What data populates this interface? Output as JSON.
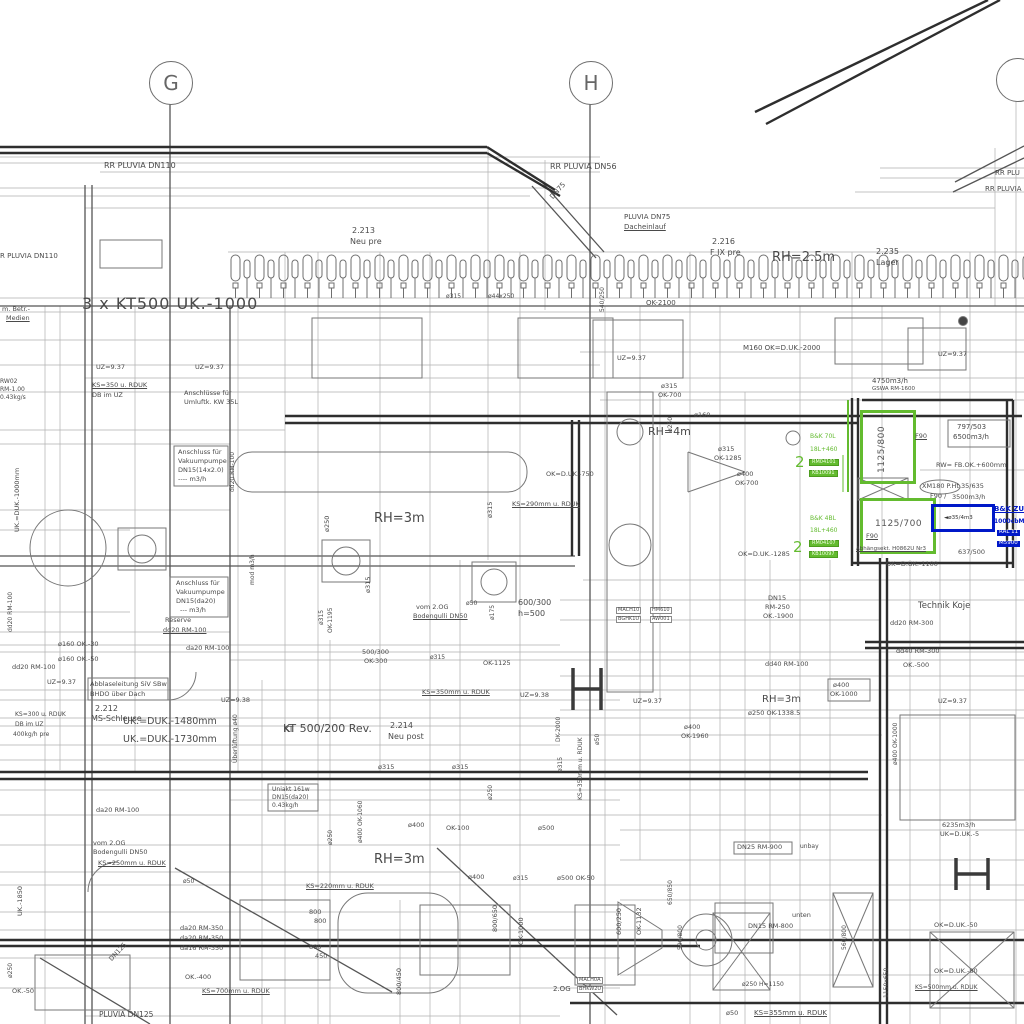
{
  "title": "HVAC / Sanitär Installationsplan (Ausschnitt)",
  "colors": {
    "line": "#6f6f6f",
    "dark": "#2e2e2e",
    "text": "#4a4a4a",
    "green": "#63bb2f",
    "blue": "#0018c8",
    "background": "#ffffff"
  },
  "grid_axes": [
    {
      "label": "G",
      "x": 149,
      "y": 61
    },
    {
      "label": "H",
      "x": 569,
      "y": 61
    },
    {
      "label": "",
      "x": 996,
      "y": 58
    }
  ],
  "equipment": {
    "supply_unit_green_1": {
      "size": "1125/800",
      "rating": "F90"
    },
    "supply_unit_green_2": {
      "size": "1125/700",
      "rating": "F90"
    },
    "blue_unit": {
      "label": "◄ø35/4m3"
    }
  },
  "annotations": [
    {
      "t": "RR PLUVIA DN110",
      "x": 104,
      "y": 162,
      "fs": 8
    },
    {
      "t": "R PLUVIA DN110",
      "x": 0,
      "y": 253,
      "fs": 7
    },
    {
      "t": "RR PLUVIA DN56",
      "x": 550,
      "y": 163,
      "fs": 8
    },
    {
      "t": "RR PLU",
      "x": 995,
      "y": 170,
      "fs": 7
    },
    {
      "t": "RR PLUVIA",
      "x": 985,
      "y": 186,
      "fs": 7
    },
    {
      "t": "DN75",
      "x": 549,
      "y": 196,
      "fs": 7,
      "r": -48
    },
    {
      "t": "PLUVIA DN75",
      "x": 624,
      "y": 214,
      "fs": 7
    },
    {
      "t": "Dacheinlauf",
      "x": 624,
      "y": 224,
      "fs": 7,
      "u": 1
    },
    {
      "t": "2.213",
      "x": 352,
      "y": 227,
      "fs": 8
    },
    {
      "t": "Neu pre",
      "x": 350,
      "y": 238,
      "fs": 8
    },
    {
      "t": "2.216",
      "x": 712,
      "y": 238,
      "fs": 8
    },
    {
      "t": "F IX pre",
      "x": 710,
      "y": 249,
      "fs": 8
    },
    {
      "t": "RH=2.5m",
      "x": 772,
      "y": 251,
      "fs": 13
    },
    {
      "t": "2.235",
      "x": 876,
      "y": 248,
      "fs": 8
    },
    {
      "t": "Lager",
      "x": 876,
      "y": 259,
      "fs": 8
    },
    {
      "t": "3 x KT500 UK.-1000",
      "x": 82,
      "y": 296,
      "fs": 16,
      "ls": 1
    },
    {
      "t": "OK-2100",
      "x": 646,
      "y": 300,
      "fs": 7
    },
    {
      "t": "m. Betr.-",
      "x": 2,
      "y": 306,
      "fs": 6.5
    },
    {
      "t": "Medien",
      "x": 6,
      "y": 315,
      "fs": 6.5,
      "u": 1
    },
    {
      "t": "UZ=9.37",
      "x": 96,
      "y": 364,
      "fs": 6.5
    },
    {
      "t": "UZ=9.37",
      "x": 195,
      "y": 364,
      "fs": 6.5
    },
    {
      "t": "UZ=9.37",
      "x": 617,
      "y": 355,
      "fs": 6.5
    },
    {
      "t": "UZ=9.37",
      "x": 938,
      "y": 351,
      "fs": 6.5
    },
    {
      "t": "KS=350 u. RDUK",
      "x": 92,
      "y": 382,
      "fs": 6.5,
      "u": 1
    },
    {
      "t": "DB im UZ",
      "x": 92,
      "y": 392,
      "fs": 6.5
    },
    {
      "t": "RW02",
      "x": 0,
      "y": 379,
      "fs": 6
    },
    {
      "t": "RM-1.00",
      "x": 0,
      "y": 387,
      "fs": 6
    },
    {
      "t": "0.43kg/s",
      "x": 0,
      "y": 395,
      "fs": 6
    },
    {
      "t": "Anschlüsse für",
      "x": 184,
      "y": 390,
      "fs": 6.5
    },
    {
      "t": "Umluftk. KW 35L",
      "x": 184,
      "y": 399,
      "fs": 6.5
    },
    {
      "t": "M160  OK=D.UK.-2000",
      "x": 743,
      "y": 345,
      "fs": 7
    },
    {
      "t": "4750m3/h",
      "x": 872,
      "y": 378,
      "fs": 7
    },
    {
      "t": "GSWA RM-1600",
      "x": 872,
      "y": 387,
      "fs": 5.5
    },
    {
      "t": "ø315",
      "x": 661,
      "y": 383,
      "fs": 6.5
    },
    {
      "t": "OK-700",
      "x": 658,
      "y": 392,
      "fs": 6.5
    },
    {
      "t": "RH=4m",
      "x": 648,
      "y": 426,
      "fs": 11
    },
    {
      "t": "ø250",
      "x": 668,
      "y": 432,
      "fs": 6,
      "r": -90
    },
    {
      "t": "ø160",
      "x": 694,
      "y": 412,
      "fs": 6.5
    },
    {
      "t": "ø315",
      "x": 718,
      "y": 446,
      "fs": 6.5
    },
    {
      "t": "OK-1285",
      "x": 714,
      "y": 455,
      "fs": 6.5
    },
    {
      "t": "ø400",
      "x": 737,
      "y": 471,
      "fs": 6.5
    },
    {
      "t": "OK-700",
      "x": 735,
      "y": 480,
      "fs": 6.5
    },
    {
      "t": "797/503",
      "x": 957,
      "y": 424,
      "fs": 7
    },
    {
      "t": "6500m3/h",
      "x": 953,
      "y": 434,
      "fs": 7
    },
    {
      "t": "RW= FB.OK.+600mm",
      "x": 936,
      "y": 462,
      "fs": 6.5
    },
    {
      "t": "XM180 P.Ht.35/635",
      "x": 922,
      "y": 483,
      "fs": 6.5
    },
    {
      "t": "F90 /",
      "x": 930,
      "y": 493,
      "fs": 6.5
    },
    {
      "t": "3500m3/h",
      "x": 952,
      "y": 494,
      "fs": 6.5
    },
    {
      "t": "B&K 70L",
      "x": 810,
      "y": 434,
      "fs": 6,
      "c": "g"
    },
    {
      "t": "18L+460",
      "x": 810,
      "y": 447,
      "fs": 6,
      "c": "g"
    },
    {
      "t": "RM04101",
      "x": 809,
      "y": 459,
      "fs": 5,
      "cls": "gbox"
    },
    {
      "t": "KB10091",
      "x": 809,
      "y": 470,
      "fs": 5,
      "cls": "gbox"
    },
    {
      "t": "2",
      "x": 795,
      "y": 455,
      "fs": 15,
      "c": "g"
    },
    {
      "t": "B&K 4BL",
      "x": 810,
      "y": 516,
      "fs": 6,
      "c": "g"
    },
    {
      "t": "18L+460",
      "x": 810,
      "y": 528,
      "fs": 6,
      "c": "g"
    },
    {
      "t": "RM04107",
      "x": 809,
      "y": 540,
      "fs": 5,
      "cls": "gbox"
    },
    {
      "t": "KB10097",
      "x": 809,
      "y": 551,
      "fs": 5,
      "cls": "gbox"
    },
    {
      "t": "2",
      "x": 793,
      "y": 540,
      "fs": 15,
      "c": "g"
    },
    {
      "t": "F90",
      "x": 915,
      "y": 433,
      "fs": 6.5,
      "u": 1
    },
    {
      "t": "F90",
      "x": 866,
      "y": 533,
      "fs": 6.5,
      "u": 1
    },
    {
      "t": "B&K ZU",
      "x": 994,
      "y": 506,
      "fs": 7,
      "c": "b",
      "u": 1
    },
    {
      "t": "1000cbM",
      "x": 994,
      "y": 519,
      "fs": 6,
      "c": "b"
    },
    {
      "t": "RAL 11",
      "x": 997,
      "y": 530,
      "fs": 5.5,
      "cls": "bbox"
    },
    {
      "t": "M5900",
      "x": 997,
      "y": 541,
      "fs": 5.5,
      "cls": "bbox"
    },
    {
      "t": "Abhängsekt. H0862U Nr3",
      "x": 856,
      "y": 547,
      "fs": 5.5,
      "u": 1
    },
    {
      "t": "637/500",
      "x": 958,
      "y": 549,
      "fs": 6.5
    },
    {
      "t": "OK=D.UK.-1100",
      "x": 886,
      "y": 561,
      "fs": 6.5
    },
    {
      "t": "OK=D.UK.-1285",
      "x": 738,
      "y": 551,
      "fs": 6.5
    },
    {
      "t": "Technik Koje",
      "x": 918,
      "y": 602,
      "fs": 8.5
    },
    {
      "t": "dd20 RM-300",
      "x": 890,
      "y": 620,
      "fs": 6.5
    },
    {
      "t": "dd40 RM-300",
      "x": 896,
      "y": 648,
      "fs": 6.5
    },
    {
      "t": "OK.-500",
      "x": 903,
      "y": 662,
      "fs": 6.5
    },
    {
      "t": "UZ=9.37",
      "x": 938,
      "y": 698,
      "fs": 6.5
    },
    {
      "t": "ø400 OK-1000",
      "x": 893,
      "y": 765,
      "fs": 6,
      "r": -90
    },
    {
      "t": "DN25  RM-900",
      "x": 737,
      "y": 844,
      "fs": 6.5
    },
    {
      "t": "unbay",
      "x": 800,
      "y": 844,
      "fs": 6
    },
    {
      "t": "6235m3/h",
      "x": 942,
      "y": 822,
      "fs": 6.5
    },
    {
      "t": "UK=D.UK.-5",
      "x": 940,
      "y": 831,
      "fs": 6.5
    },
    {
      "t": "RH=3m",
      "x": 374,
      "y": 512,
      "fs": 13
    },
    {
      "t": "OK=D.UK.-750",
      "x": 546,
      "y": 471,
      "fs": 6.5
    },
    {
      "t": "KS=290mm u. RDUK",
      "x": 512,
      "y": 501,
      "fs": 6.5,
      "u": 1
    },
    {
      "t": "ø250",
      "x": 324,
      "y": 532,
      "fs": 6.5,
      "r": -90
    },
    {
      "t": "ø315",
      "x": 487,
      "y": 518,
      "fs": 6.5,
      "r": -90
    },
    {
      "t": "ø315",
      "x": 365,
      "y": 593,
      "fs": 6.5,
      "r": -90
    },
    {
      "t": "ø315",
      "x": 319,
      "y": 625,
      "fs": 6,
      "r": -90
    },
    {
      "t": "OK-1195",
      "x": 328,
      "y": 633,
      "fs": 6,
      "r": -90
    },
    {
      "t": "ø175",
      "x": 490,
      "y": 620,
      "fs": 6,
      "r": -90
    },
    {
      "t": "vom 2.OG",
      "x": 416,
      "y": 604,
      "fs": 6.5
    },
    {
      "t": "Bodengulli DN50",
      "x": 413,
      "y": 613,
      "fs": 6.5,
      "u": 1
    },
    {
      "t": "ø50",
      "x": 466,
      "y": 601,
      "fs": 6
    },
    {
      "t": "600/300",
      "x": 518,
      "y": 599,
      "fs": 8
    },
    {
      "t": "h=500",
      "x": 518,
      "y": 610,
      "fs": 8
    },
    {
      "t": "DN15",
      "x": 768,
      "y": 595,
      "fs": 6.5
    },
    {
      "t": "RM-250",
      "x": 765,
      "y": 604,
      "fs": 6.5
    },
    {
      "t": "OK.-1900",
      "x": 763,
      "y": 613,
      "fs": 6.5
    },
    {
      "t": "dd40 RM-100",
      "x": 765,
      "y": 661,
      "fs": 6.5
    },
    {
      "t": "ø400",
      "x": 833,
      "y": 682,
      "fs": 6.5
    },
    {
      "t": "OK-1000",
      "x": 830,
      "y": 691,
      "fs": 6.5
    },
    {
      "t": "RH=3m",
      "x": 762,
      "y": 695,
      "fs": 10
    },
    {
      "t": "ø250 OK-1338.5",
      "x": 748,
      "y": 710,
      "fs": 6.5
    },
    {
      "t": "ø400",
      "x": 684,
      "y": 724,
      "fs": 6.5
    },
    {
      "t": "OK-1960",
      "x": 681,
      "y": 733,
      "fs": 6.5
    },
    {
      "t": "UZ=9.37",
      "x": 633,
      "y": 698,
      "fs": 6.5
    },
    {
      "t": "500/300",
      "x": 362,
      "y": 649,
      "fs": 6.5
    },
    {
      "t": "OK-300",
      "x": 364,
      "y": 658,
      "fs": 6.5
    },
    {
      "t": "ø315",
      "x": 430,
      "y": 655,
      "fs": 6
    },
    {
      "t": "OK-1125",
      "x": 483,
      "y": 660,
      "fs": 6.5
    },
    {
      "t": "ø160  OK.-30",
      "x": 58,
      "y": 641,
      "fs": 6.5
    },
    {
      "t": "ø160  OK.-50",
      "x": 58,
      "y": 656,
      "fs": 6.5
    },
    {
      "t": "dd20 RM-100",
      "x": 12,
      "y": 664,
      "fs": 6.5
    },
    {
      "t": "da20 RM-100",
      "x": 186,
      "y": 645,
      "fs": 6.5
    },
    {
      "t": "UZ=9.37",
      "x": 47,
      "y": 679,
      "fs": 6.5
    },
    {
      "t": "Abblaseleitung SiV SBw",
      "x": 90,
      "y": 681,
      "fs": 6.5
    },
    {
      "t": "BHDO über Dach",
      "x": 90,
      "y": 691,
      "fs": 6.5
    },
    {
      "t": "2.212",
      "x": 95,
      "y": 705,
      "fs": 8
    },
    {
      "t": "MS-Schleuse",
      "x": 91,
      "y": 715,
      "fs": 8
    },
    {
      "t": "UK.=DUK.-1480mm",
      "x": 123,
      "y": 717,
      "fs": 9.5
    },
    {
      "t": "UK.=DUK.-1730mm",
      "x": 123,
      "y": 735,
      "fs": 9.5
    },
    {
      "t": "UZ=9.38",
      "x": 221,
      "y": 697,
      "fs": 6.5
    },
    {
      "t": "Überlüftung ø40",
      "x": 233,
      "y": 763,
      "fs": 6,
      "r": -90
    },
    {
      "t": "KS=300 u. RDUK",
      "x": 15,
      "y": 712,
      "fs": 6
    },
    {
      "t": "DB im UZ",
      "x": 15,
      "y": 722,
      "fs": 6
    },
    {
      "t": "400kg/h pre",
      "x": 13,
      "y": 732,
      "fs": 6
    },
    {
      "t": "KT",
      "x": 284,
      "y": 726,
      "fs": 8
    },
    {
      "t": "Reserve",
      "x": 165,
      "y": 617,
      "fs": 6.5
    },
    {
      "t": "dd20 RM-100",
      "x": 163,
      "y": 627,
      "fs": 6.5,
      "u": 1
    },
    {
      "t": "Anschluss für",
      "x": 178,
      "y": 449,
      "fs": 6.5
    },
    {
      "t": "Vakuumpumpe",
      "x": 178,
      "y": 458,
      "fs": 6.5
    },
    {
      "t": "DN15(14x2.0)",
      "x": 178,
      "y": 467,
      "fs": 6.5
    },
    {
      "t": "---- m3/h",
      "x": 178,
      "y": 476,
      "fs": 6.5
    },
    {
      "t": "Anschluss für",
      "x": 176,
      "y": 580,
      "fs": 6.5
    },
    {
      "t": "Vakuumpumpe",
      "x": 176,
      "y": 589,
      "fs": 6.5
    },
    {
      "t": "DN15(da20)",
      "x": 176,
      "y": 598,
      "fs": 6.5
    },
    {
      "t": "--- m3/h",
      "x": 180,
      "y": 607,
      "fs": 6.5
    },
    {
      "t": "UK.=DUK.-1000mm",
      "x": 14,
      "y": 532,
      "fs": 6.5,
      "r": -90
    },
    {
      "t": "dd20 RM-100",
      "x": 8,
      "y": 632,
      "fs": 6,
      "r": -90
    },
    {
      "t": "dd20 RM-100",
      "x": 230,
      "y": 492,
      "fs": 6,
      "r": -90
    },
    {
      "t": "mod m3/h",
      "x": 250,
      "y": 585,
      "fs": 6,
      "r": -90
    },
    {
      "t": "da20 RM-100",
      "x": 96,
      "y": 807,
      "fs": 6.5
    },
    {
      "t": "vom 2.OG",
      "x": 93,
      "y": 840,
      "fs": 6.5
    },
    {
      "t": "Bodengulli DN50",
      "x": 93,
      "y": 849,
      "fs": 6.5
    },
    {
      "t": "KS=250mm u. RDUK",
      "x": 98,
      "y": 860,
      "fs": 6.5,
      "u": 1
    },
    {
      "t": "UK.-1850",
      "x": 17,
      "y": 916,
      "fs": 6.5,
      "r": -90
    },
    {
      "t": "DN125",
      "x": 108,
      "y": 958,
      "fs": 6.5,
      "r": -47
    },
    {
      "t": "ø50",
      "x": 183,
      "y": 879,
      "fs": 6
    },
    {
      "t": "da20 RM-350",
      "x": 180,
      "y": 925,
      "fs": 6.5
    },
    {
      "t": "da20 RM-350",
      "x": 180,
      "y": 935,
      "fs": 6.5
    },
    {
      "t": "da16 RM-350",
      "x": 180,
      "y": 945,
      "fs": 6.5
    },
    {
      "t": "OK.-400",
      "x": 185,
      "y": 974,
      "fs": 6.5
    },
    {
      "t": "KS=700mm u. RDUK",
      "x": 202,
      "y": 988,
      "fs": 6.5,
      "u": 1
    },
    {
      "t": "OK.-50",
      "x": 12,
      "y": 988,
      "fs": 6.5
    },
    {
      "t": "ø250",
      "x": 8,
      "y": 978,
      "fs": 6,
      "r": -90
    },
    {
      "t": "PLUVIA DN125",
      "x": 99,
      "y": 1011,
      "fs": 7.5
    },
    {
      "t": "Uniakt 161w",
      "x": 272,
      "y": 787,
      "fs": 6
    },
    {
      "t": "DN15(da20)",
      "x": 272,
      "y": 795,
      "fs": 6
    },
    {
      "t": "0.43kg/h",
      "x": 272,
      "y": 803,
      "fs": 6
    },
    {
      "t": "RH=3m",
      "x": 374,
      "y": 853,
      "fs": 13
    },
    {
      "t": "KS=220mm u. RDUK",
      "x": 306,
      "y": 883,
      "fs": 6.5,
      "u": 1
    },
    {
      "t": "800",
      "x": 309,
      "y": 909,
      "fs": 6.5
    },
    {
      "t": "800",
      "x": 314,
      "y": 918,
      "fs": 6.5
    },
    {
      "t": "800",
      "x": 309,
      "y": 944,
      "fs": 6.5
    },
    {
      "t": "450",
      "x": 315,
      "y": 953,
      "fs": 6.5
    },
    {
      "t": "ø400",
      "x": 468,
      "y": 874,
      "fs": 6.5
    },
    {
      "t": "ø315",
      "x": 513,
      "y": 876,
      "fs": 6
    },
    {
      "t": "ø500  OK-50",
      "x": 557,
      "y": 875,
      "fs": 6.5
    },
    {
      "t": "800/650",
      "x": 492,
      "y": 932,
      "fs": 6.5,
      "r": -90
    },
    {
      "t": "OK-1000",
      "x": 518,
      "y": 945,
      "fs": 6.5,
      "r": -90
    },
    {
      "t": "800/450",
      "x": 396,
      "y": 995,
      "fs": 6.5,
      "r": -90
    },
    {
      "t": "600/250",
      "x": 616,
      "y": 935,
      "fs": 6.5,
      "r": -90
    },
    {
      "t": "OK-1132",
      "x": 636,
      "y": 935,
      "fs": 6.5,
      "r": -90
    },
    {
      "t": "2.OG",
      "x": 553,
      "y": 986,
      "fs": 7
    },
    {
      "t": "MACH0A",
      "x": 577,
      "y": 977,
      "fs": 5,
      "cls": "box"
    },
    {
      "t": "BHKW2U",
      "x": 577,
      "y": 986,
      "fs": 5,
      "cls": "box"
    },
    {
      "t": "MACH10",
      "x": 616,
      "y": 607,
      "fs": 5,
      "cls": "box"
    },
    {
      "t": "BGHK1U",
      "x": 616,
      "y": 616,
      "fs": 5,
      "cls": "box"
    },
    {
      "t": "HM610",
      "x": 650,
      "y": 607,
      "fs": 5,
      "cls": "box"
    },
    {
      "t": "AW001",
      "x": 650,
      "y": 616,
      "fs": 5,
      "cls": "box"
    },
    {
      "t": "DN15  RM-800",
      "x": 748,
      "y": 923,
      "fs": 6.5
    },
    {
      "t": "unten",
      "x": 792,
      "y": 912,
      "fs": 6.5
    },
    {
      "t": "OK=D.UK.-50",
      "x": 934,
      "y": 922,
      "fs": 6.5
    },
    {
      "t": "OK=D.UK.-80",
      "x": 934,
      "y": 968,
      "fs": 6.5
    },
    {
      "t": "KS=500mm u. RDUK",
      "x": 915,
      "y": 985,
      "fs": 6,
      "u": 1
    },
    {
      "t": "ø250  H=1150",
      "x": 742,
      "y": 982,
      "fs": 6
    },
    {
      "t": "KS=355mm u. RDUK",
      "x": 754,
      "y": 1010,
      "fs": 7,
      "u": 1
    },
    {
      "t": "ø50",
      "x": 726,
      "y": 1010,
      "fs": 6.5
    },
    {
      "t": "650/850",
      "x": 668,
      "y": 905,
      "fs": 6,
      "r": -90
    },
    {
      "t": "590/800",
      "x": 678,
      "y": 950,
      "fs": 6,
      "r": -90
    },
    {
      "t": "560/800",
      "x": 842,
      "y": 950,
      "fs": 6,
      "r": -90
    },
    {
      "t": "1150x650",
      "x": 884,
      "y": 998,
      "fs": 6,
      "r": -90
    },
    {
      "t": "540/250",
      "x": 600,
      "y": 312,
      "fs": 6,
      "r": -90
    },
    {
      "t": "ø315",
      "x": 446,
      "y": 294,
      "fs": 6
    },
    {
      "t": "ø44x250",
      "x": 488,
      "y": 294,
      "fs": 6
    },
    {
      "t": "KS=350mm u. RDUK",
      "x": 422,
      "y": 689,
      "fs": 6.5,
      "u": 1
    },
    {
      "t": "UZ=9.38",
      "x": 520,
      "y": 692,
      "fs": 6.5
    },
    {
      "t": "KT 500/200 Rev.",
      "x": 283,
      "y": 723,
      "fs": 11
    },
    {
      "t": "2.214",
      "x": 390,
      "y": 722,
      "fs": 8
    },
    {
      "t": "Neu post",
      "x": 388,
      "y": 733,
      "fs": 8
    },
    {
      "t": "ø315",
      "x": 378,
      "y": 764,
      "fs": 6.5
    },
    {
      "t": "ø315",
      "x": 452,
      "y": 764,
      "fs": 6.5
    },
    {
      "t": "DK-2000",
      "x": 556,
      "y": 742,
      "fs": 6,
      "r": -90
    },
    {
      "t": "ø315",
      "x": 558,
      "y": 772,
      "fs": 6,
      "r": -90
    },
    {
      "t": "KS=350mm u. RDUK",
      "x": 578,
      "y": 800,
      "fs": 6,
      "r": -90
    },
    {
      "t": "ø50",
      "x": 595,
      "y": 745,
      "fs": 6,
      "r": -90
    },
    {
      "t": "ø250",
      "x": 328,
      "y": 845,
      "fs": 6,
      "r": -90
    },
    {
      "t": "ø400 OK-1060",
      "x": 358,
      "y": 843,
      "fs": 6,
      "r": -90
    },
    {
      "t": "ø400",
      "x": 408,
      "y": 822,
      "fs": 6.5
    },
    {
      "t": "OK-100",
      "x": 446,
      "y": 825,
      "fs": 6.5
    },
    {
      "t": "ø500",
      "x": 538,
      "y": 825,
      "fs": 6.5
    },
    {
      "t": "ø250",
      "x": 488,
      "y": 800,
      "fs": 6,
      "r": -90
    }
  ]
}
